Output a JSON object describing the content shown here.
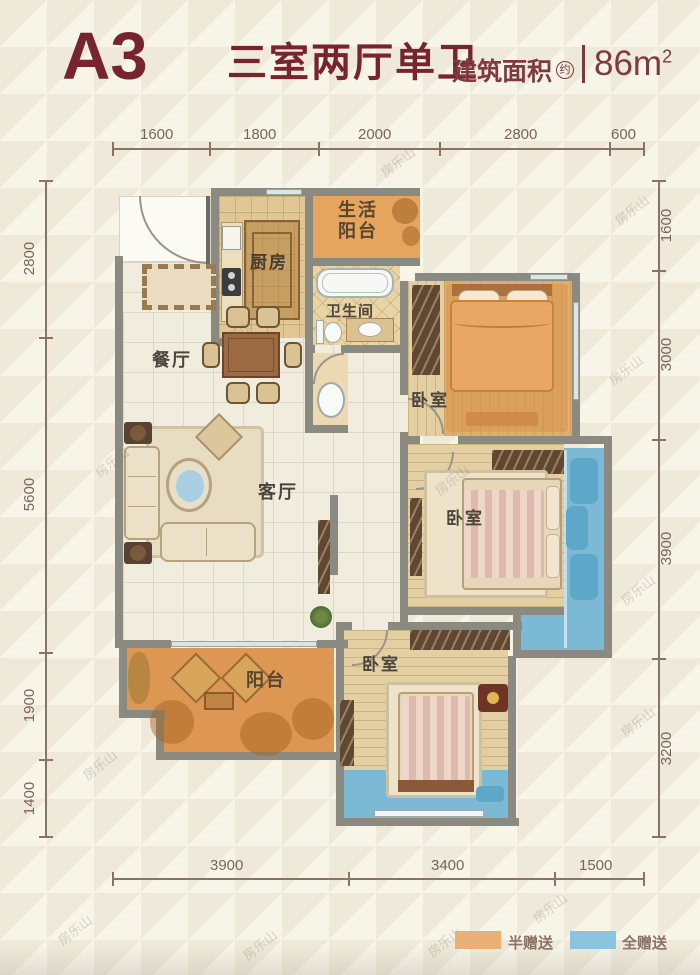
{
  "header": {
    "unit": "A3",
    "layout_name": "三室两厅单卫",
    "area_label": "建筑面积",
    "area_circle": "约",
    "area_value_main": "86m",
    "area_value_sup": "2"
  },
  "dims": {
    "top": [
      "1600",
      "1800",
      "2000",
      "2800",
      "600"
    ],
    "left": [
      "2800",
      "5600",
      "1900",
      "1400"
    ],
    "right": [
      "1600",
      "3000",
      "3900",
      "3200"
    ],
    "bottom": [
      "3900",
      "3400",
      "1500"
    ]
  },
  "rooms": {
    "kitchen": "厨房",
    "life_balcony_1": "生活",
    "life_balcony_2": "阳台",
    "bathroom": "卫生间",
    "dining": "餐厅",
    "living": "客厅",
    "balcony": "阳台",
    "bedroom": "卧室"
  },
  "legend": [
    {
      "label": "半赠送",
      "color": "#E9B077"
    },
    {
      "label": "全赠送",
      "color": "#8AC4DE"
    }
  ],
  "watermark": {
    "text": "房乐山"
  },
  "colors": {
    "title": "#78242E",
    "half_gift_orange": "#E2A45E",
    "full_gift_blue": "#7CB9D4",
    "wall_gray": "#8B8A81",
    "dimension": "#7A6458"
  }
}
